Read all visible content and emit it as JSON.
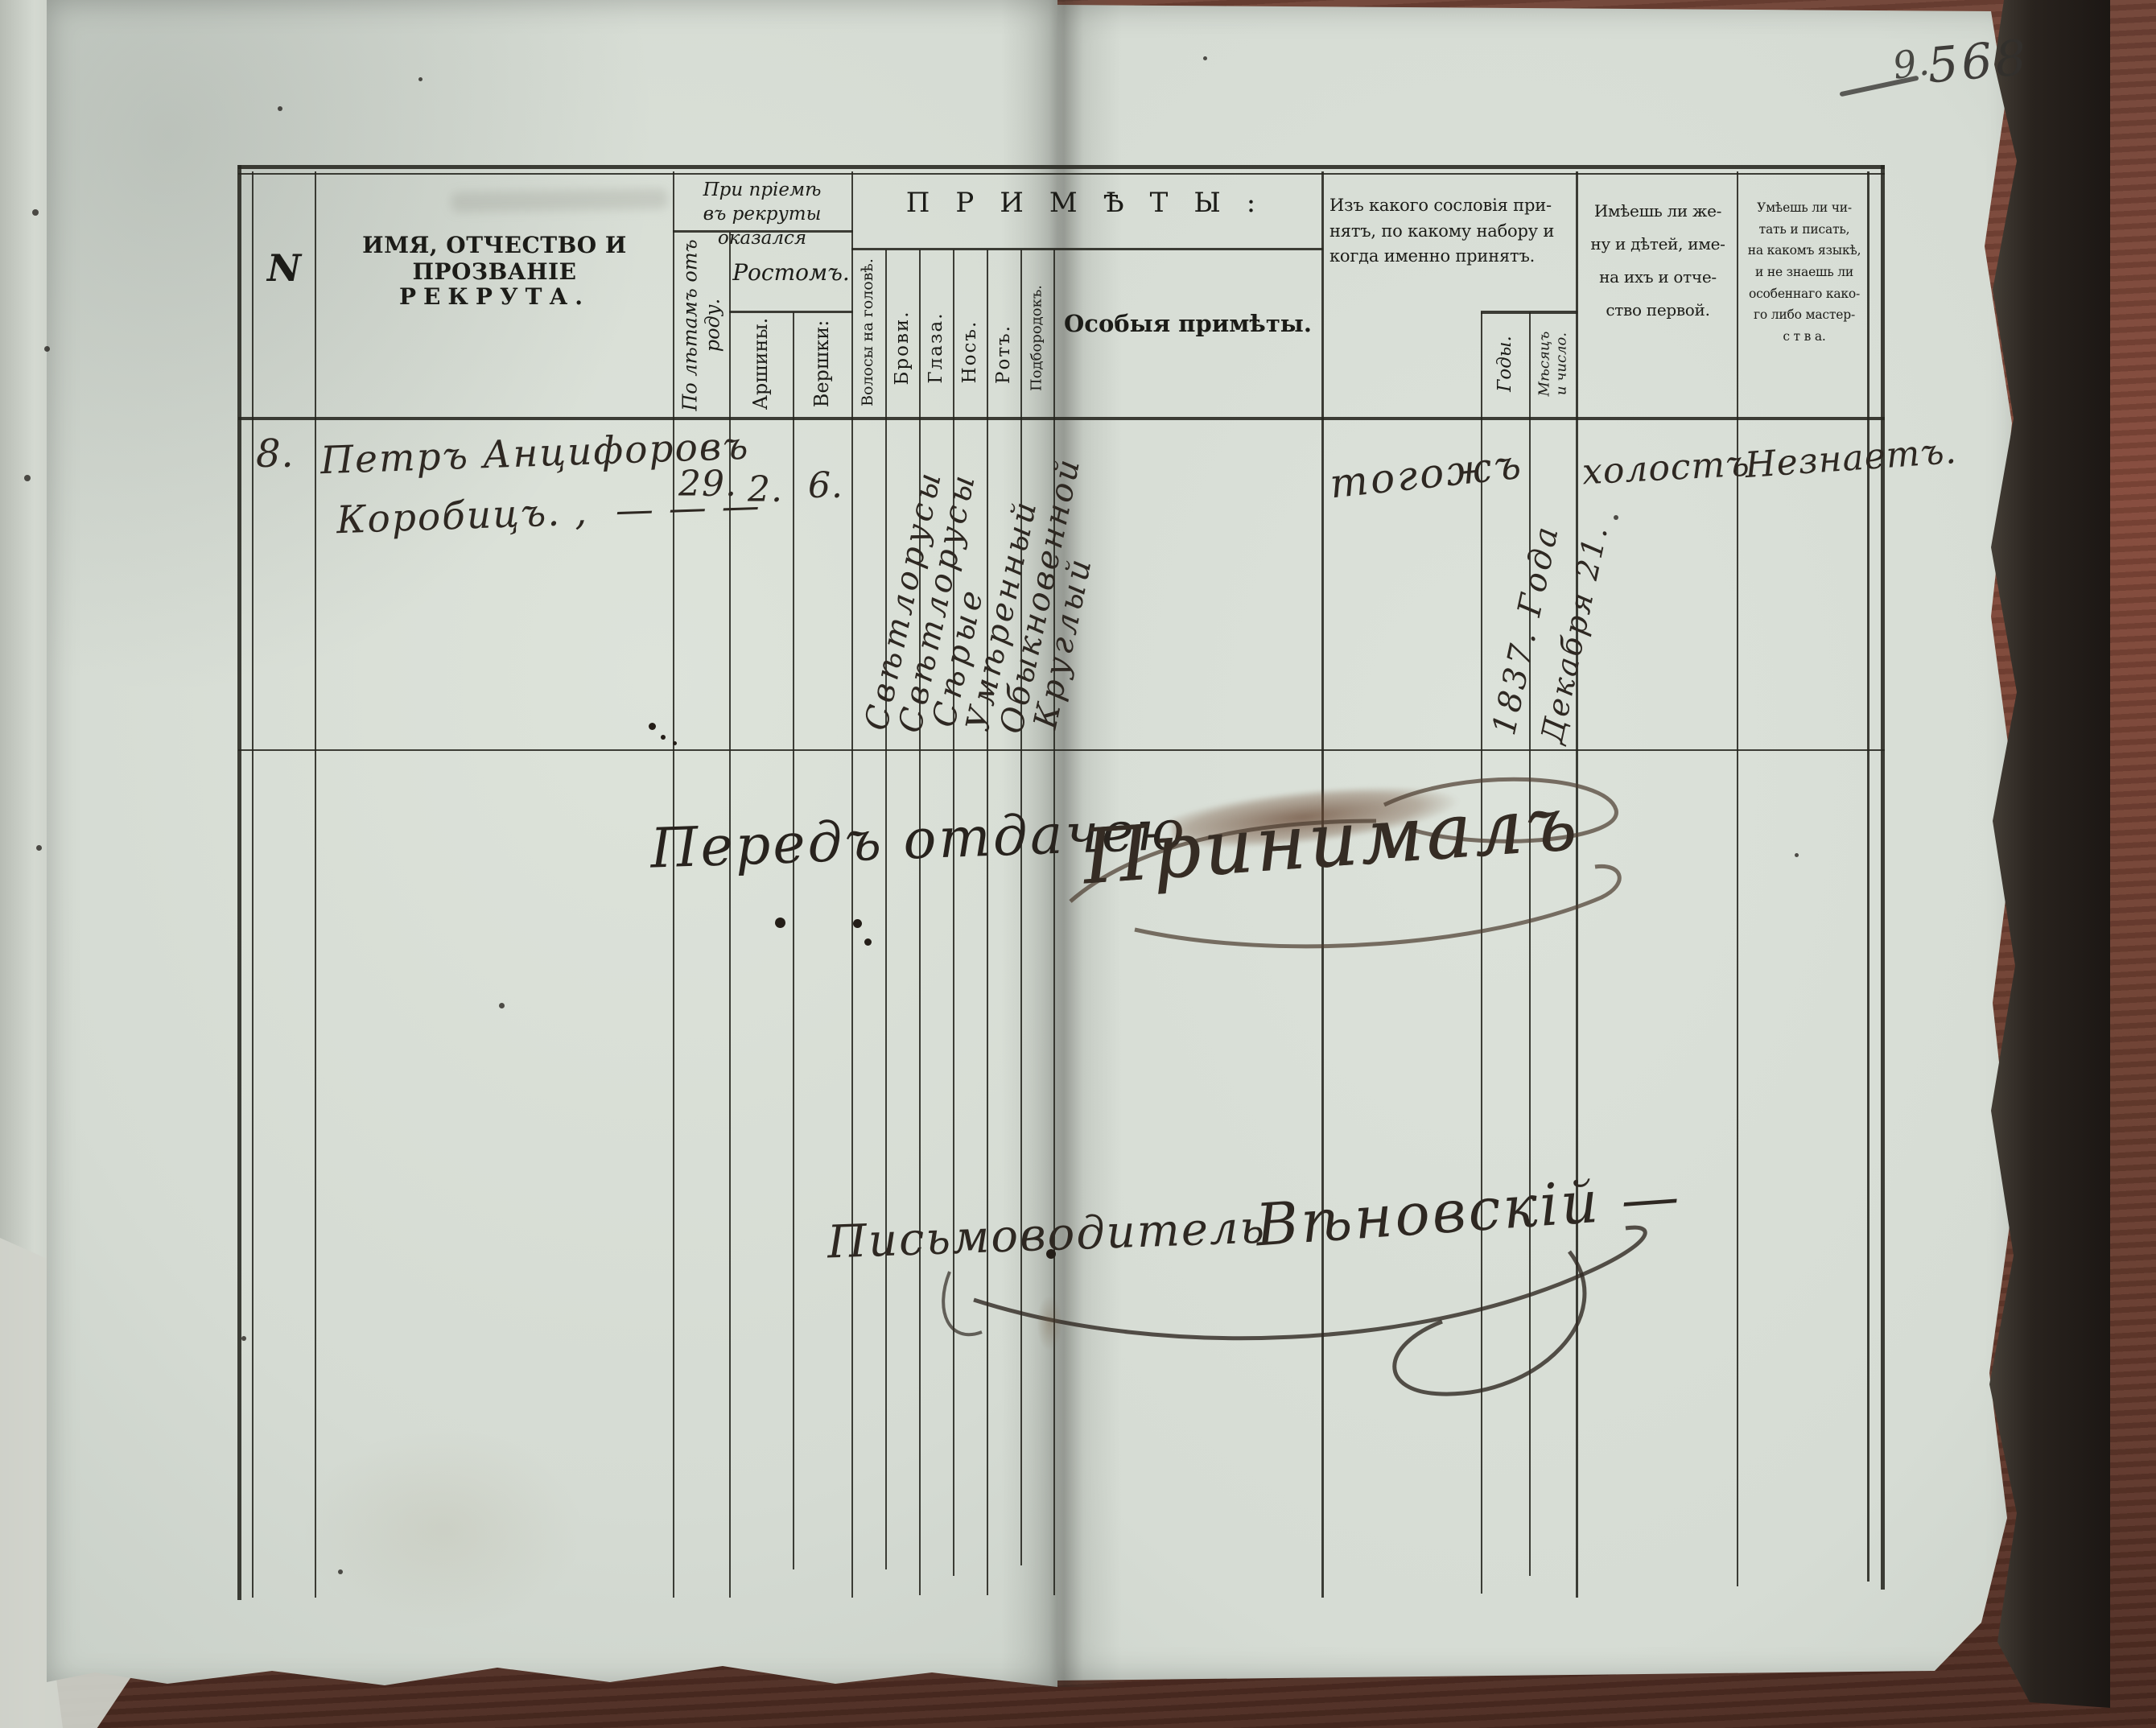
{
  "document": {
    "folio": {
      "note": "9.",
      "number": "568"
    },
    "table": {
      "number_col": "N",
      "name_col_line1": "ИМЯ, ОТЧЕСТВО И ПРОЗВАНІЕ",
      "name_col_line2": "РЕКРУТА.",
      "admission_group": "При пріемѣ\nвъ рекруты\nоказался",
      "age_col": "По лѣтамъ отъ\nроду.",
      "height_group": "Ростомъ.",
      "arshins_col": "Аршины.",
      "vershoks_col": "Вершки:",
      "marks_group": "ПРИМѢТЫ:",
      "hair_col": "Волосы на головѣ.",
      "brows_col": "Брови.",
      "eyes_col": "Глаза.",
      "nose_col": "Носъ.",
      "mouth_col": "Ротъ.",
      "chin_col": "Подбородокъ.",
      "special_marks_col": "Особыя примѣты.",
      "estate_col": "Изъ какого сословія при-\nнятъ, по какому набору и\nкогда именно принятъ.",
      "years_col": "Годы.",
      "month_day_col": "Мѣсяцъ\nи число.",
      "family_col": "Имѣешь ли же-\nну и дѣтей, име-\nна ихъ и отче-\nство первой.",
      "literacy_col": "Умѣешь ли чи-\nтать и писать,\nна какомъ языкѣ,\nи не знаешь ли\nособеннаго како-\nго либо мастер-\nс т в а."
    },
    "entry": {
      "number": "8.",
      "name_line1": "Петръ Анцифоровъ",
      "name_line2": "Коробицъ. ,  — — —",
      "age_years": "29.",
      "height_arshins": "2.",
      "height_vershoks": "6.",
      "hair": "Свѣтлорусы",
      "brows": "Свѣтлорусы",
      "eyes": "Сѣрые",
      "nose": "Умѣренный",
      "mouth": "Обыкновенной",
      "chin": "Круглый",
      "estate": "тогожъ",
      "accepted_year": "1837. Года",
      "accepted_date": "Декабря 21.",
      "family": "холостъ",
      "literacy": "Незнаетъ."
    },
    "annotations": {
      "handover_note": "Передъ отдачею",
      "acceptance_signature": "Принималъ",
      "clerk_title": "Письмоводитель",
      "clerk_signature": "Вѣновскій —"
    }
  }
}
